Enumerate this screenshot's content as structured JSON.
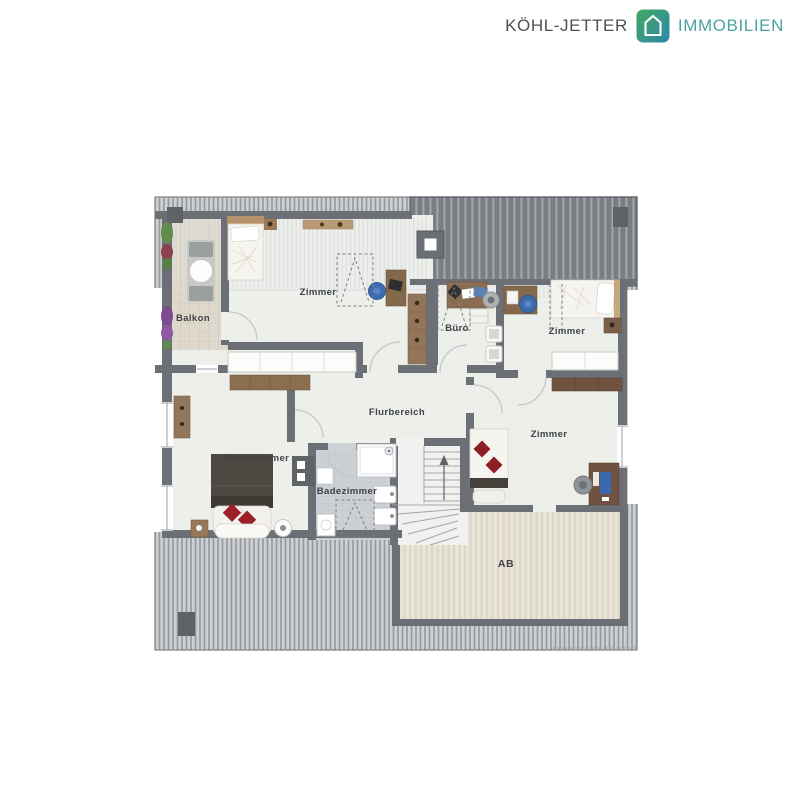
{
  "logo": {
    "brand": "KÖHL-JETTER",
    "suffix": "IMMOBILIEN",
    "icon": "house-icon",
    "brand_color": "#4c5157",
    "suffix_color": "#4ba3a0",
    "icon_gradient_start": "#44a95e",
    "icon_gradient_end": "#2f86ac"
  },
  "plan": {
    "rooms": {
      "balcony": "Balkon",
      "room_top_left": "Zimmer",
      "office": "Büro",
      "room_top_right": "Zimmer",
      "hallway": "Flurbereich",
      "bedroom": "Schlafzimmer",
      "bathroom": "Badezimmer",
      "room_bottom_right": "Zimmer",
      "attic_storage": "AB"
    },
    "note": "Exposéplan, nicht maßstäblich",
    "colors": {
      "wall": "#6c7076",
      "room_floor": "#edefeb",
      "roof_hatch_dark": "#7a7e84",
      "roof_hatch_light": "#cdd0d2",
      "accent_red": "#9c2026",
      "accent_blue": "#3c6cb0"
    }
  }
}
